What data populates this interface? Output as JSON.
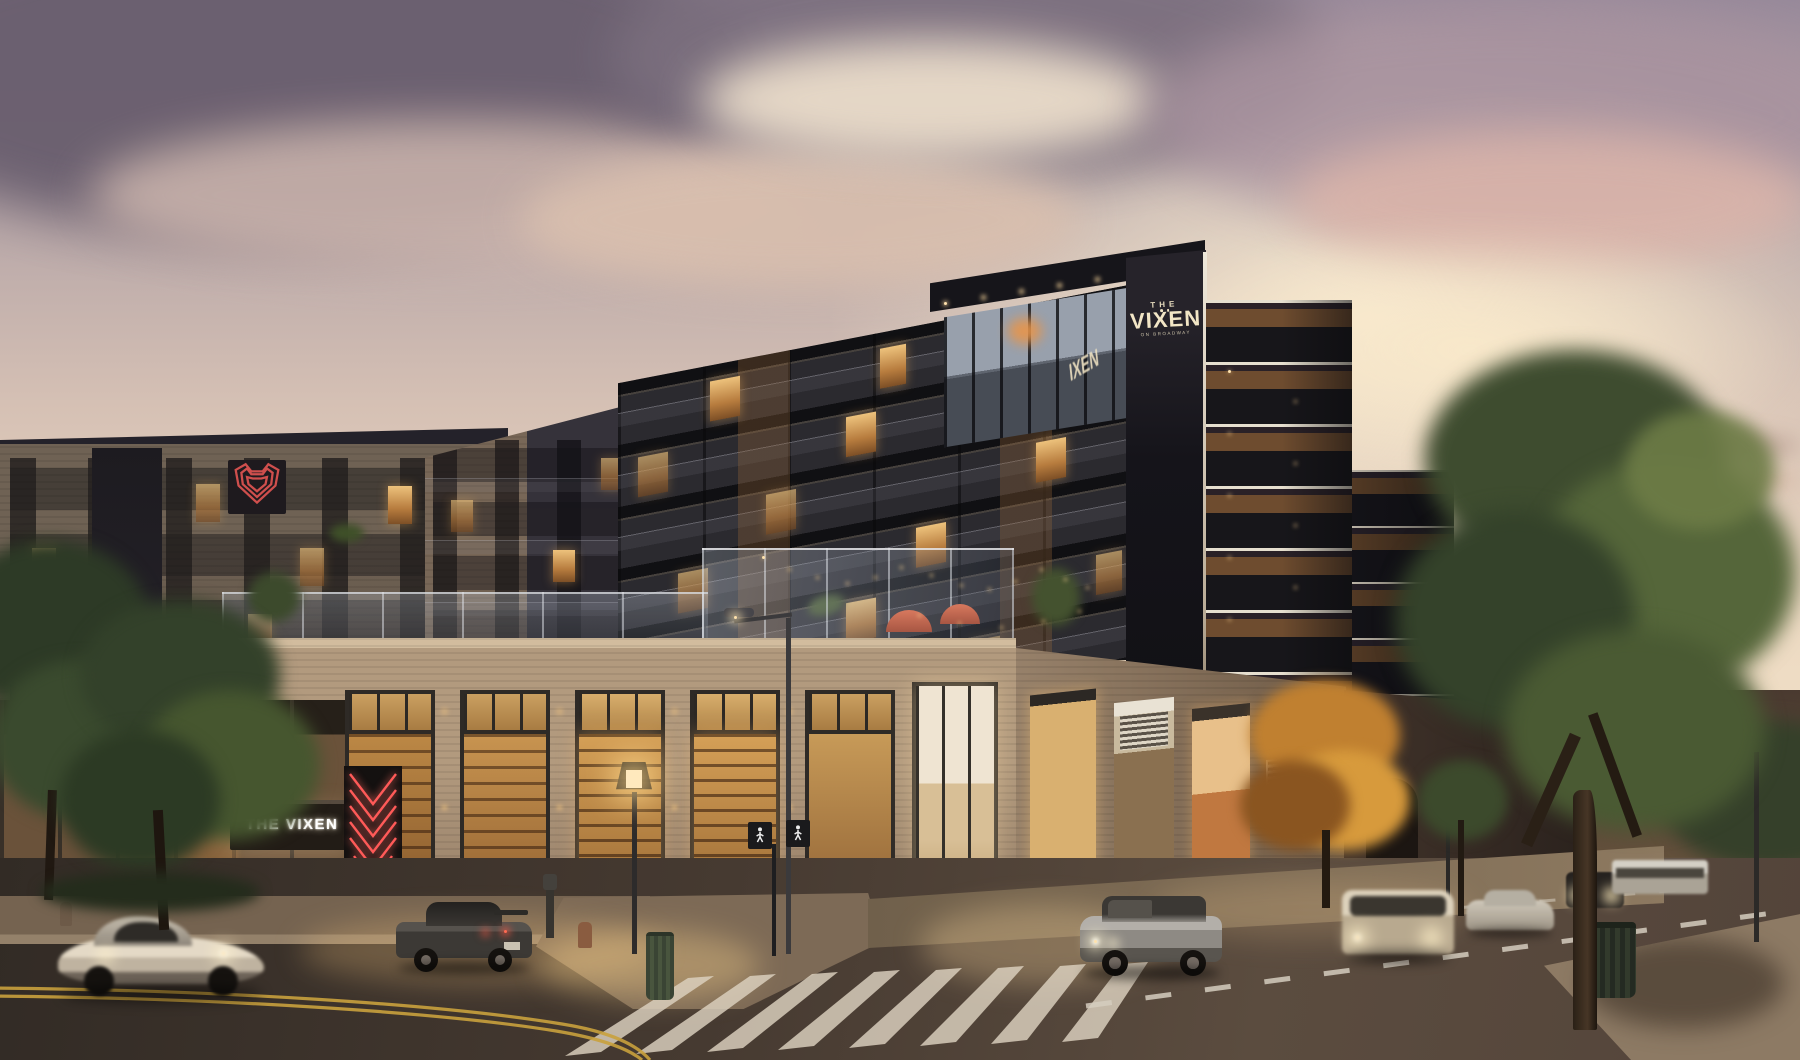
{
  "meta": {
    "title": "The Vixen mixed-use building — dusk architectural rendering",
    "scene_type": "architectural rendering, street corner at dusk"
  },
  "signs": {
    "rooftop": {
      "top": "THE",
      "main": "VIXEN",
      "sub": "ON BROADWAY"
    },
    "side_partial": "IXEN",
    "marquee": "THE VIXEN"
  },
  "palette": {
    "sky_top": "#97899a",
    "sky_horizon": "#f3e3c8",
    "cloud_dark": "#6d6270",
    "cloud_warm": "#d9bfae",
    "building_dark": "#232227",
    "building_black": "#141318",
    "podium_brick": "#bca286",
    "left_brick": "#6b5e52",
    "window_warm": "#e8a85f",
    "neon_red": "#ff5a58",
    "sign_cream": "#f2e6c6",
    "road": "#4a3e35",
    "marking_yellow": "#c9a13d",
    "marking_white": "#d9d0c2"
  },
  "scene": {
    "vehicles": [
      "white sports car (motion blur)",
      "dark parked sedan",
      "silver suv",
      "white van (motion blur)",
      "silver sedan",
      "dark offroad vehicle",
      "city bus"
    ],
    "street_objects": [
      "ornate street lamp",
      "cobra street light",
      "pedestrian signals",
      "green trash can",
      "dark trash can",
      "fire hydrant",
      "parking meter"
    ],
    "vegetation": [
      "street trees left",
      "autumn orange tree",
      "large green tree right"
    ],
    "features": [
      "rooftop terrace with string lights",
      "glass penthouse corner",
      "red neon fox marquee",
      "red fox logo panel",
      "restaurant storefronts",
      "zebra crosswalk"
    ]
  }
}
